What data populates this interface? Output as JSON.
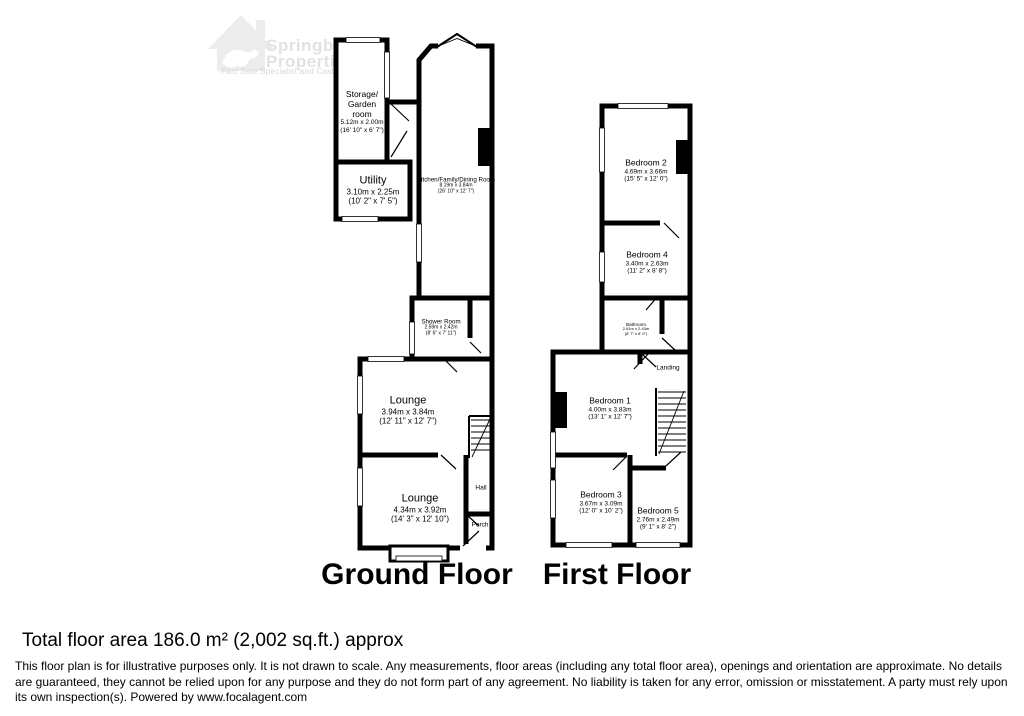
{
  "watermark": {
    "line1": "Springbok",
    "line2": "Properties",
    "tagline": "Fast Sale Specialist and Cash Buyer"
  },
  "ground_floor": {
    "title": "Ground Floor",
    "rooms": {
      "storage": {
        "name": "Storage/\nGarden\nroom",
        "metric": "5.12m x 2.00m",
        "imperial": "(16' 10\" x 6' 7\")"
      },
      "utility": {
        "name": "Utility",
        "metric": "3.10m x 2.25m",
        "imperial": "(10' 2\" x 7' 5\")"
      },
      "kitchen": {
        "name": "Kitchen/Family/Dining Room",
        "metric": "8.19m x 3.84m",
        "imperial": "(26' 10\" x 12' 7\")"
      },
      "shower": {
        "name": "Shower Room",
        "metric": "2.59m x 2.42m",
        "imperial": "(8' 6\" x 7' 11\")"
      },
      "lounge1": {
        "name": "Lounge",
        "metric": "3.94m x 3.84m",
        "imperial": "(12' 11\" x 12' 7\")"
      },
      "lounge2": {
        "name": "Lounge",
        "metric": "4.34m x 3.92m",
        "imperial": "(14' 3\" x 12' 10\")"
      },
      "hall": {
        "name": "Hall"
      },
      "porch": {
        "name": "Porch"
      }
    }
  },
  "first_floor": {
    "title": "First Floor",
    "rooms": {
      "bedroom2": {
        "name": "Bedroom 2",
        "metric": "4.69m x 3.66m",
        "imperial": "(15' 5\" x 12' 0\")"
      },
      "bedroom4": {
        "name": "Bedroom 4",
        "metric": "3.40m x 2.63m",
        "imperial": "(11' 2\" x 8' 8\")"
      },
      "bathroom": {
        "name": "Bathroom",
        "metric": "2.61m x 2.43m",
        "imperial": "(8' 7\" x 8' 0\")"
      },
      "landing": {
        "name": "Landing"
      },
      "bedroom1": {
        "name": "Bedroom 1",
        "metric": "4.00m x 3.83m",
        "imperial": "(13' 1\" x 12' 7\")"
      },
      "bedroom3": {
        "name": "Bedroom 3",
        "metric": "3.67m x 3.09m",
        "imperial": "(12' 0\" x 10' 2\")"
      },
      "bedroom5": {
        "name": "Bedroom 5",
        "metric": "2.76m x 2.49m",
        "imperial": "(9' 1\" x 8' 2\")"
      }
    }
  },
  "footer": {
    "total_area": "Total floor area 186.0 m² (2,002 sq.ft.) approx",
    "disclaimer": "This floor plan is for illustrative purposes only. It is not drawn to scale. Any measurements, floor areas (including any total floor area), openings and orientation are approximate. No details are guaranteed, they cannot be relied upon for any purpose and they do not form part of any agreement. No liability is taken for any error, omission or misstatement. A party must rely upon its own inspection(s). Powered by www.focalagent.com"
  },
  "colors": {
    "wall": "#000000",
    "watermark_icon": "#ececec",
    "watermark_text": "#e2e2e2"
  }
}
